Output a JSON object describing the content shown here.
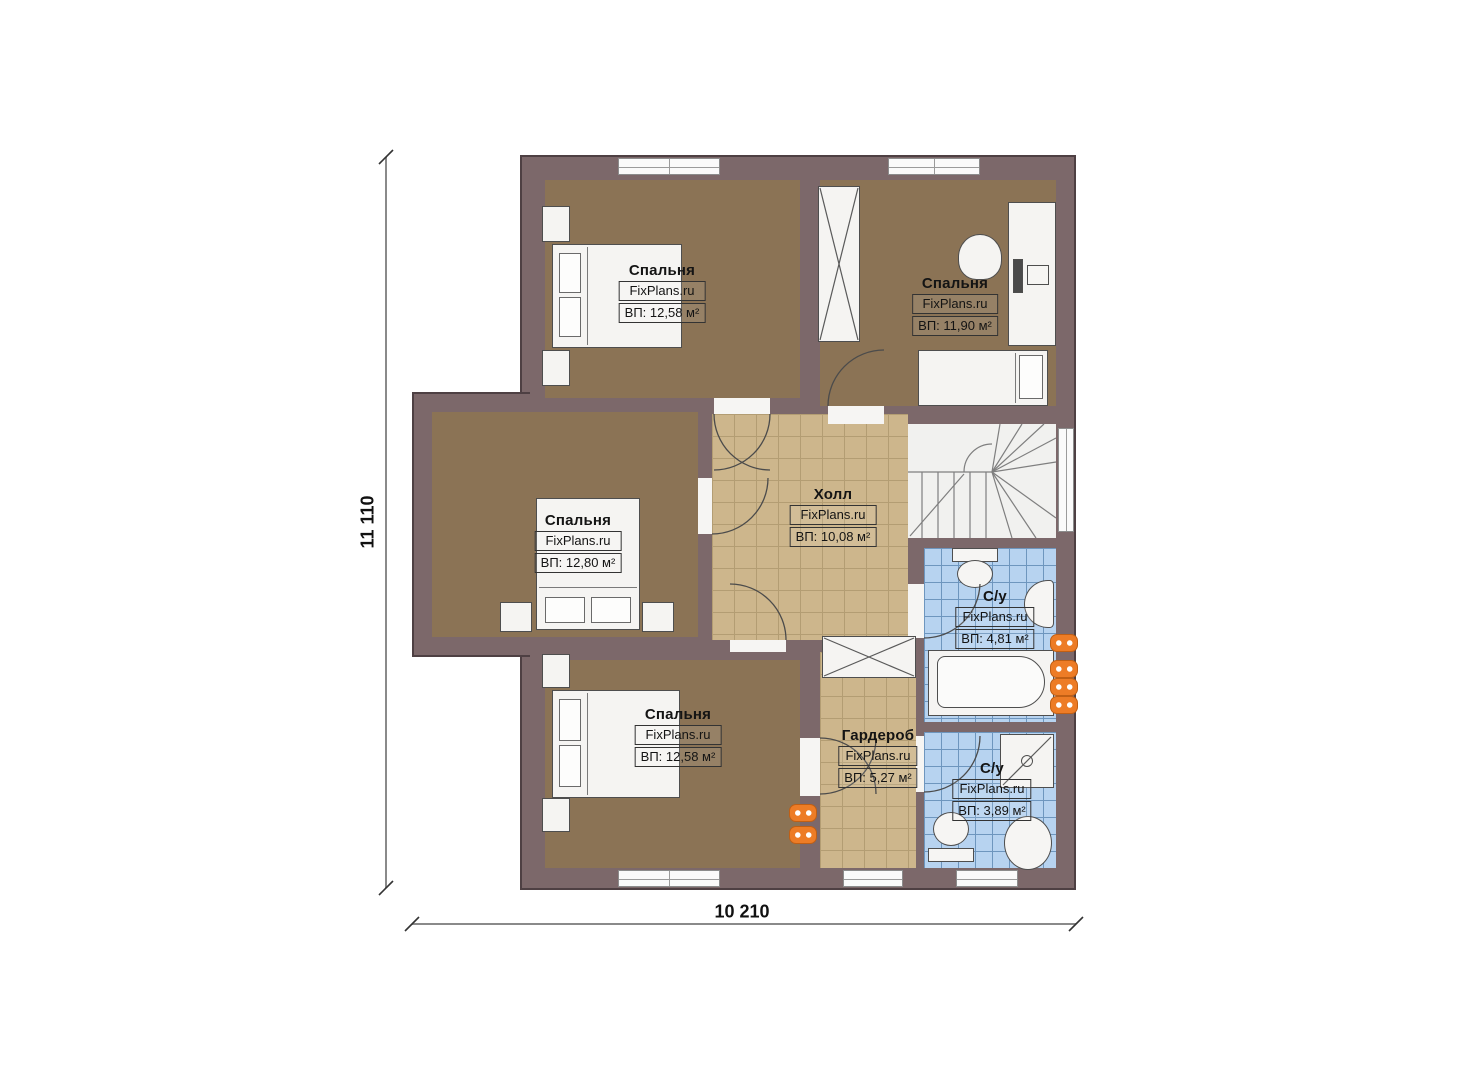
{
  "dimensions": {
    "vertical": "11 110",
    "horizontal": "10 210"
  },
  "rooms": [
    {
      "key": "bedroom-top-left",
      "name": "Спальня",
      "watermark": "FixPlans.ru",
      "area_label": "ВП: 12,58 м²"
    },
    {
      "key": "bedroom-top-right",
      "name": "Спальня",
      "watermark": "FixPlans.ru",
      "area_label": "ВП: 11,90 м²"
    },
    {
      "key": "bedroom-middle-left",
      "name": "Спальня",
      "watermark": "FixPlans.ru",
      "area_label": "ВП: 12,80 м²"
    },
    {
      "key": "hall",
      "name": "Холл",
      "watermark": "FixPlans.ru",
      "area_label": "ВП: 10,08 м²"
    },
    {
      "key": "bathroom-upper",
      "name": "С/у",
      "watermark": "FixPlans.ru",
      "area_label": "ВП: 4,81 м²"
    },
    {
      "key": "wardrobe",
      "name": "Гардероб",
      "watermark": "FixPlans.ru",
      "area_label": "ВП: 5,27 м²"
    },
    {
      "key": "bathroom-lower",
      "name": "С/у",
      "watermark": "FixPlans.ru",
      "area_label": "ВП: 3,89 м²"
    },
    {
      "key": "bedroom-bottom-left",
      "name": "Спальня",
      "watermark": "FixPlans.ru",
      "area_label": "ВП: 12,58 м²"
    }
  ],
  "colors": {
    "wall": "#7c686a",
    "carpet_floor": "#8b7355",
    "tile_tan_floor": "#cdb68c",
    "tile_blue_floor": "#b7d3f0",
    "radiator_orange": "#ed7c26",
    "fixture_white": "#f5f4f2"
  }
}
